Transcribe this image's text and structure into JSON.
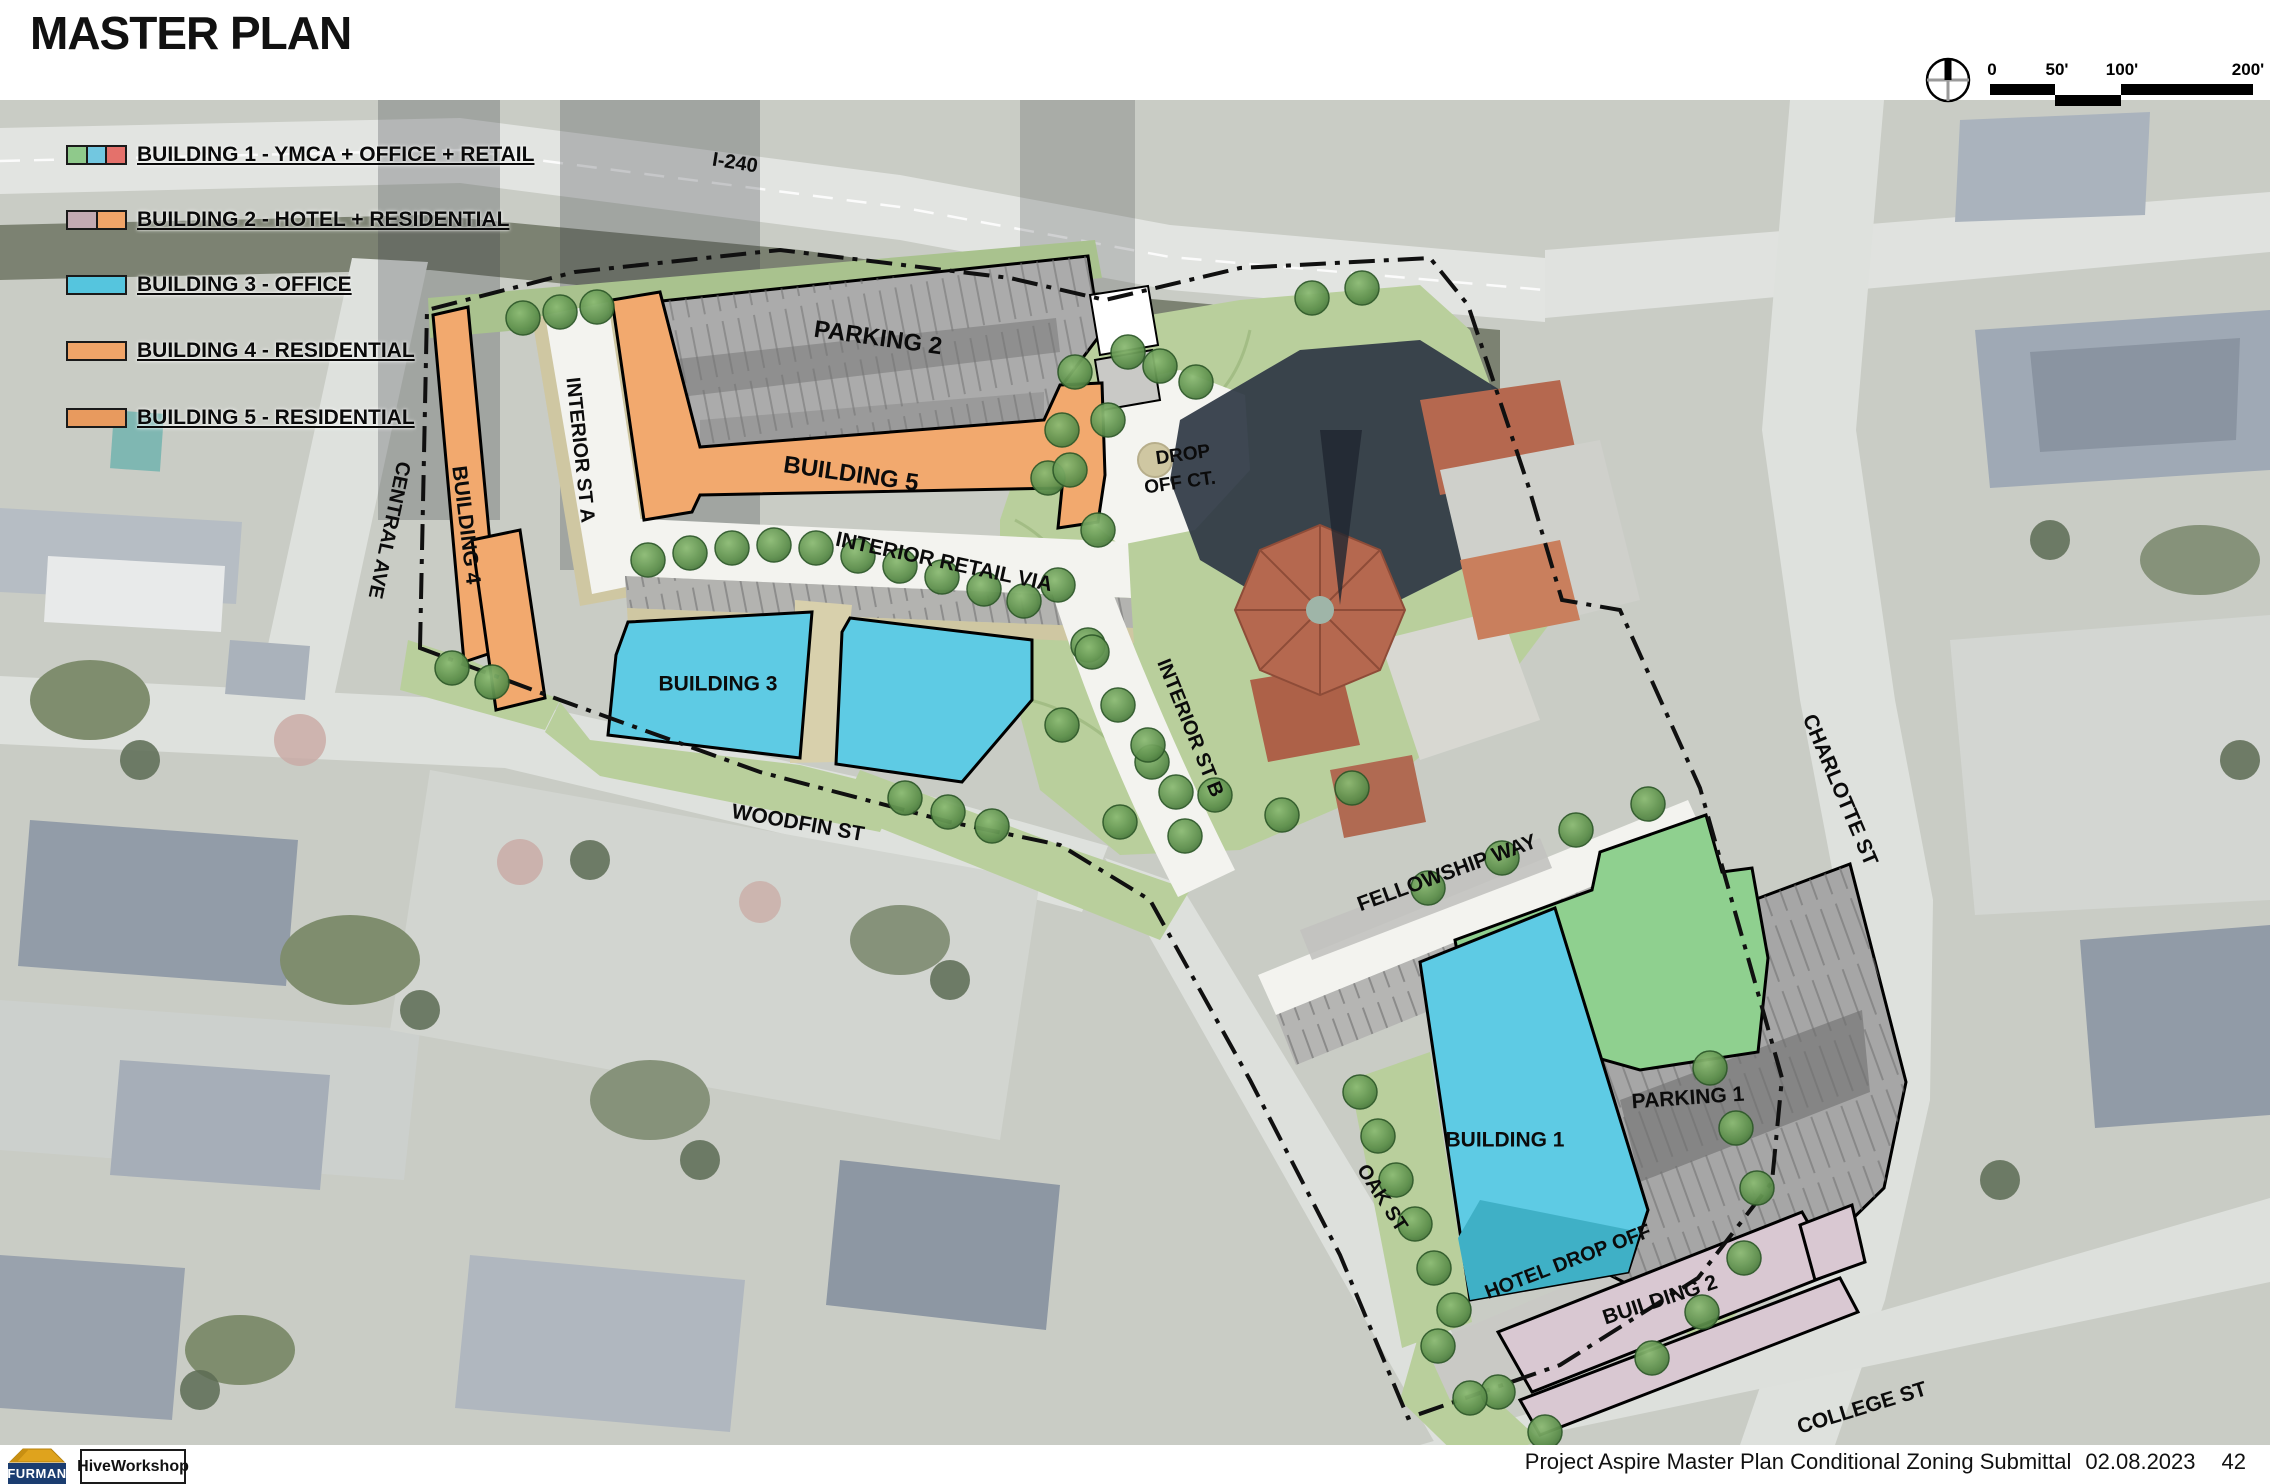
{
  "title": "MASTER PLAN",
  "legend": {
    "items": [
      {
        "label": "BUILDING 1 - YMCA + OFFICE + RETAIL",
        "swatches": [
          "#8fc98b",
          "#72c7e0",
          "#e4716b"
        ]
      },
      {
        "label": "BUILDING 2 - HOTEL + RESIDENTIAL",
        "swatches": [
          "#c3aab2",
          "#f0a468"
        ]
      },
      {
        "label": "BUILDING 3 - OFFICE",
        "swatches": [
          "#55c5de"
        ]
      },
      {
        "label": "BUILDING 4 - RESIDENTIAL",
        "swatches": [
          "#f0a468"
        ]
      },
      {
        "label": "BUILDING 5 - RESIDENTIAL",
        "swatches": [
          "#e89a5e"
        ]
      }
    ]
  },
  "scale_bar": {
    "labels": [
      "0",
      "50'",
      "100'",
      "200'"
    ]
  },
  "north_arrow": {
    "icon": "north-arrow-compass"
  },
  "plan": {
    "areas": {
      "parking2": "PARKING 2",
      "building5": "BUILDING 5",
      "building4": "BUILDING 4",
      "building3": "BUILDING 3",
      "building1": "BUILDING 1",
      "parking1": "PARKING 1",
      "building2": "BUILDING 2",
      "hotel_drop_off": "HOTEL DROP OFF",
      "drop_off_line1": "DROP",
      "drop_off_line2": "OFF CT."
    },
    "streets": {
      "i240": "I-240",
      "central_ave": "CENTRAL AVE",
      "interior_st_a": "INTERIOR ST A",
      "interior_retail_via": "INTERIOR RETAIL VIA",
      "interior_st_b": "INTERIOR ST B",
      "woodfin": "WOODFIN ST",
      "fellowship": "FELLOWSHIP WAY",
      "charlotte": "CHARLOTTE ST",
      "oak": "OAK ST",
      "college": "COLLEGE ST"
    },
    "colors": {
      "office_cyan": "#5ecbe4",
      "residential_orange": "#f2a96e",
      "hotel_pink": "#d9c8d2",
      "ymca_green": "#8fd08f",
      "retail_red": "#e4716b",
      "parking_gray": "#ababab",
      "lawn_green": "#b9cf9c"
    }
  },
  "footer": {
    "text": "Project Aspire Master Plan Conditional Zoning Submittal",
    "date": "02.08.2023",
    "page": "42"
  },
  "logos": {
    "furman": "FURMAN",
    "hive": "HiveWorkshop"
  }
}
